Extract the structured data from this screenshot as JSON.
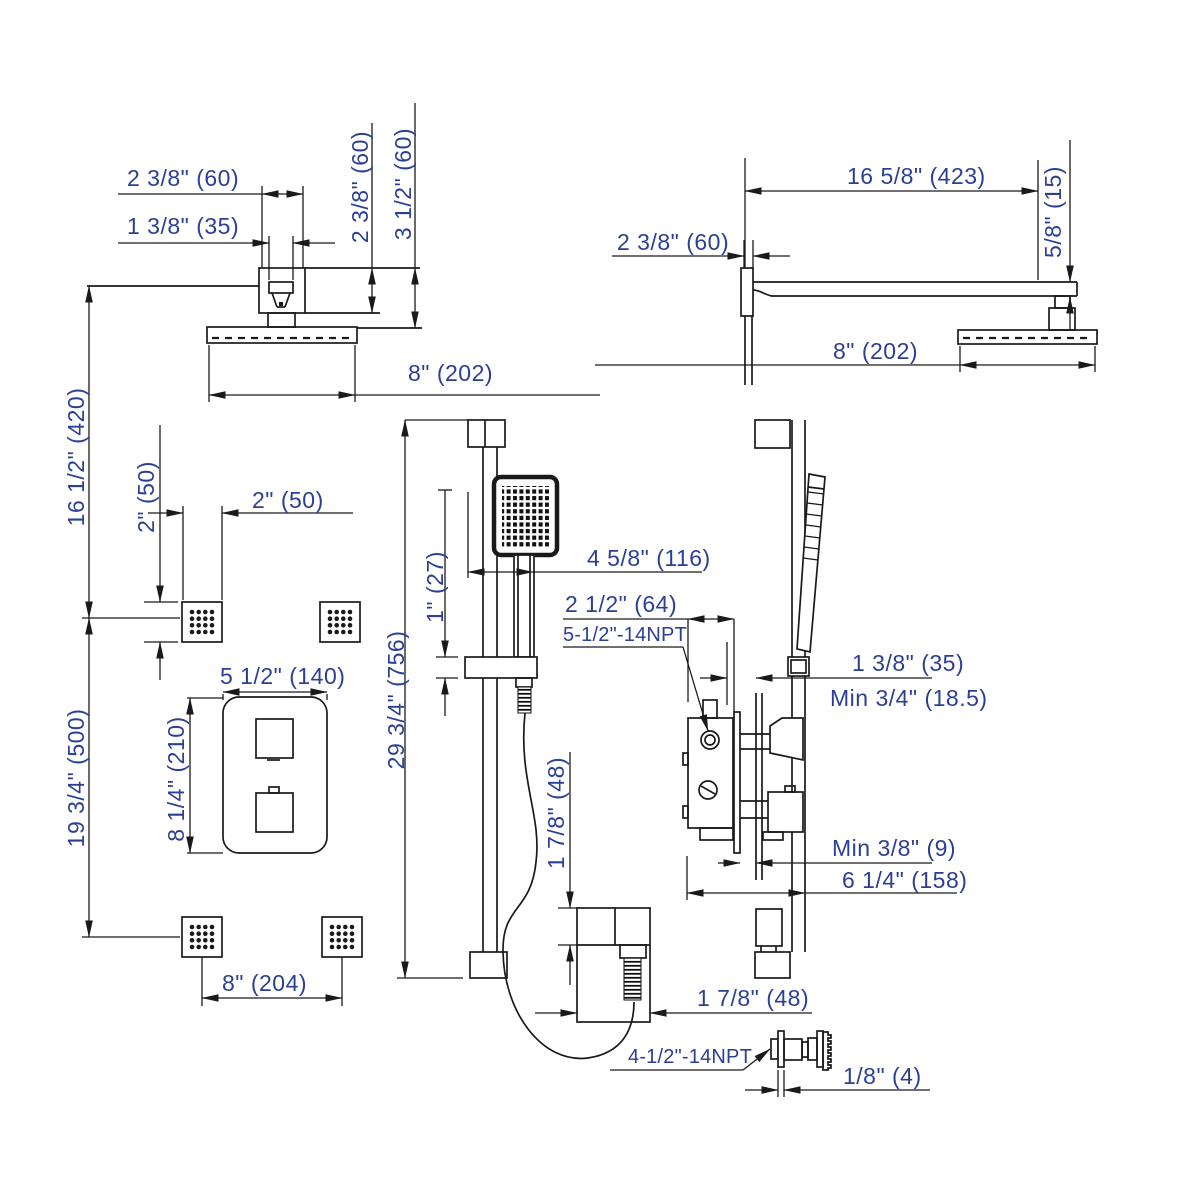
{
  "drawing": {
    "title": "shower-system-rough-in-dimension-drawing",
    "colors": {
      "line": "#1a1a1a",
      "dimension_text": "#2b3f94",
      "background": "#ffffff"
    }
  },
  "dims": {
    "ceil_head_flange_w": "2 3/8\" (60)",
    "ceil_head_pipe_w": "1 3/8\" (35)",
    "ceil_head_flange_h": "2 3/8\" (60)",
    "ceil_head_total_h": "3 1/2\" (60)",
    "ceil_head_face_w": "8\" (202)",
    "arm_length": "16 5/8\" (423)",
    "arm_flange": "2 3/8\" (60)",
    "arm_drop": "5/8\" (15)",
    "wall_head_face_w": "8\" (202)",
    "head_to_jet1": "16 1/2\" (420)",
    "jet_h": "2\" (50)",
    "jet_w": "2\" (50)",
    "jet1_to_jet2": "19 3/4\" (500)",
    "valve_plate_w": "5 1/2\" (140)",
    "valve_plate_h": "8 1/4\" (210)",
    "jet_spacing": "8\" (204)",
    "bar_length": "29 3/4\" (756)",
    "holder_h": "1\" (27)",
    "bar_offset": "4 5/8\" (116)",
    "valve_depth": "2 1/2\" (64)",
    "valve_thread": "5-1/2\"-14NPT",
    "bracket_to_wall": "1 3/8\" (35)",
    "min_depth": "Min 3/4\" (18.5)",
    "min_gap": "Min 3/8\" (9)",
    "total_depth": "6 1/4\" (158)",
    "outlet_h": "1 7/8\" (48)",
    "outlet_w": "1 7/8\" (48)",
    "jet_thread": "4-1/2\"-14NPT",
    "jet_flange_t": "1/8\" (4)"
  }
}
